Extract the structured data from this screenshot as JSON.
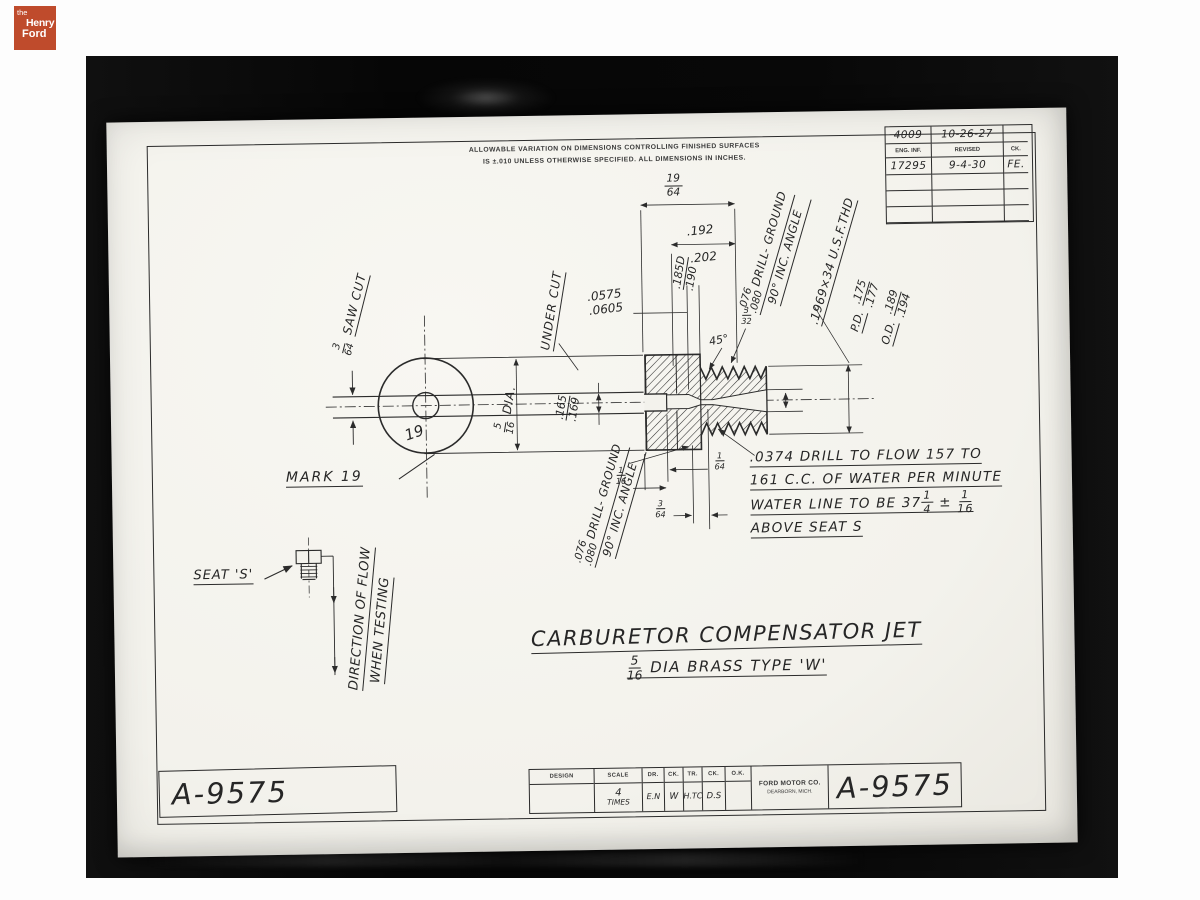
{
  "logo": {
    "the": "the",
    "henry": "Henry",
    "ford": "Ford"
  },
  "tolerance_note": {
    "line1": "ALLOWABLE VARIATION ON DIMENSIONS CONTROLLING FINISHED SURFACES",
    "line2": "IS ±.010 UNLESS OTHERWISE SPECIFIED.   ALL DIMENSIONS IN INCHES."
  },
  "revision_table": {
    "entry_number": "4009",
    "entry_date": "10-26-27",
    "col_eng_inf": "ENG. INF.",
    "col_revised": "REVISED",
    "col_ck": "CK.",
    "rev_number": "17295",
    "rev_date": "9-4-30",
    "rev_ck": "FE."
  },
  "front_view": {
    "saw_cut_num": "3",
    "saw_cut_den": "64",
    "saw_cut_label": "SAW CUT",
    "mark_label": "MARK 19",
    "stamp": "19"
  },
  "section": {
    "under_cut": "UNDER CUT",
    "orifice_hi": ".0575",
    "orifice_lo": ".0605",
    "dia_num": "5",
    "dia_den": "16",
    "dia_label": "DIA.",
    "slot_hi": ".165",
    "slot_lo": ".169",
    "len_num": "19",
    "len_den": "64",
    "thread_hi": ".192",
    "thread_lo": ".202",
    "drill_hi": ".185D",
    "drill_lo": ".190",
    "chamfer_num": "3",
    "chamfer_den": "32",
    "angle": "45°",
    "dg_top_hi": ".076",
    "dg_top_lo": ".080",
    "dg_top_text": "DRILL- GROUND",
    "dg_top_text2": "90° INC. ANGLE",
    "thread_spec": ".1969×34 U.S.F.THD",
    "pd_label": "P.D.",
    "pd_hi": ".175",
    "pd_lo": ".177",
    "od_label": "O.D.",
    "od_hi": ".189",
    "od_lo": ".194",
    "dg_bot_hi": ".076",
    "dg_bot_lo": ".080",
    "dg_bot_text": "DRILL- GROUND",
    "dg_bot_text2": "90° INC. ANGLE",
    "d116_num": "1",
    "d116_den": "16",
    "d164_num": "1",
    "d164_den": "64",
    "d364_num": "3",
    "d364_den": "64"
  },
  "seat": {
    "label": "SEAT 'S'",
    "flow1": "DIRECTION OF FLOW",
    "flow2": "WHEN TESTING"
  },
  "note": {
    "line1": ".0374 DRILL TO FLOW 157 TO",
    "line2": "161 C.C. OF WATER PER MINUTE",
    "line3a": "WATER LINE TO BE 37",
    "f1n": "1",
    "f1d": "4",
    "pm": "±",
    "f2n": "1",
    "f2d": "16",
    "line4": "ABOVE SEAT S"
  },
  "title": {
    "main": "CARBURETOR COMPENSATOR JET",
    "sub_num": "5",
    "sub_den": "16",
    "sub_rest": "DIA BRASS TYPE 'W'"
  },
  "drawing_number": "A-9575",
  "title_block": {
    "design": "DESIGN",
    "design_val": "",
    "scale": "SCALE",
    "scale_num": "4",
    "scale_word": "TIMES",
    "dr": "DR.",
    "dr_val": "E.N",
    "ck1": "CK.",
    "ck1_val": "W",
    "tr": "TR.",
    "tr_val": "H.TC",
    "ck2": "CK.",
    "ck2_val": "D.S",
    "ok": "O.K.",
    "ok_val": "",
    "company1": "FORD MOTOR CO.",
    "company2": "DEARBORN, MICH.",
    "number": "A-9575"
  },
  "colors": {
    "logo_bg": "#bf4b2c",
    "paper": "#f5f4ef",
    "ink": "#2b2b2b",
    "photo_bg": "#0a0a0a"
  }
}
